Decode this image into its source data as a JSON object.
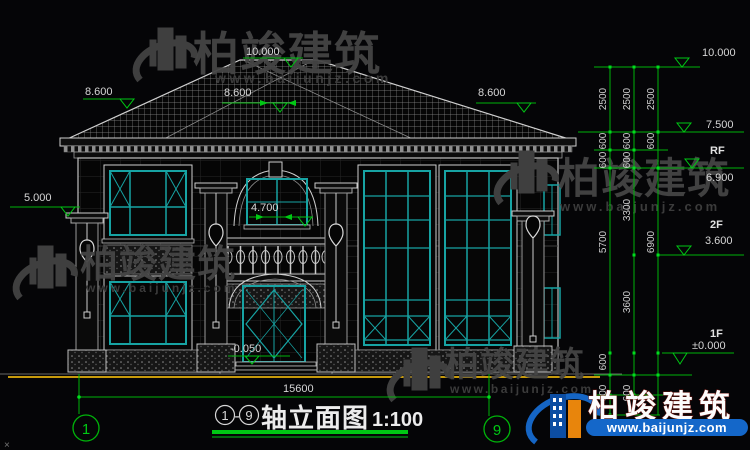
{
  "title": {
    "a1": "1",
    "dash": "-",
    "a9": "9",
    "name": "轴立面图",
    "scale": "1:100"
  },
  "watermark": {
    "brand": "柏竣建筑",
    "url": "www.baijunjz.com"
  },
  "axes": {
    "left": "1",
    "right": "9"
  },
  "dims": {
    "ridge": "10.000",
    "eave_left": "8.600",
    "eave_center": "8.600",
    "eave_right": "8.600",
    "pillar": "5.000",
    "balcony": "4.700",
    "entrance": "-0.050",
    "total_width": "15600"
  },
  "levels": {
    "l10": "10.000",
    "l75": "7.500",
    "rf": "RF",
    "l69": "6.900",
    "f2": "2F",
    "l36": "3.600",
    "f1": "1F",
    "l0": "±0.000"
  },
  "chain": {
    "s2500": [
      "2500",
      "2500",
      "2500"
    ],
    "s600u": [
      "600",
      "600",
      "600",
      "600",
      "600"
    ],
    "s3300": "3300",
    "s5700": "5700",
    "s6900": "6900",
    "s3600": "3600",
    "s600l": [
      "600",
      "600",
      "600"
    ]
  },
  "misc": {
    "corner": "×"
  },
  "colors": {
    "dim_green": "#00b40a",
    "window_teal": "#17a3a3",
    "ground_yellow": "#c79a0c",
    "logo_blue": "#1565c4",
    "logo_orange": "#e8850c",
    "background": "#050507"
  }
}
